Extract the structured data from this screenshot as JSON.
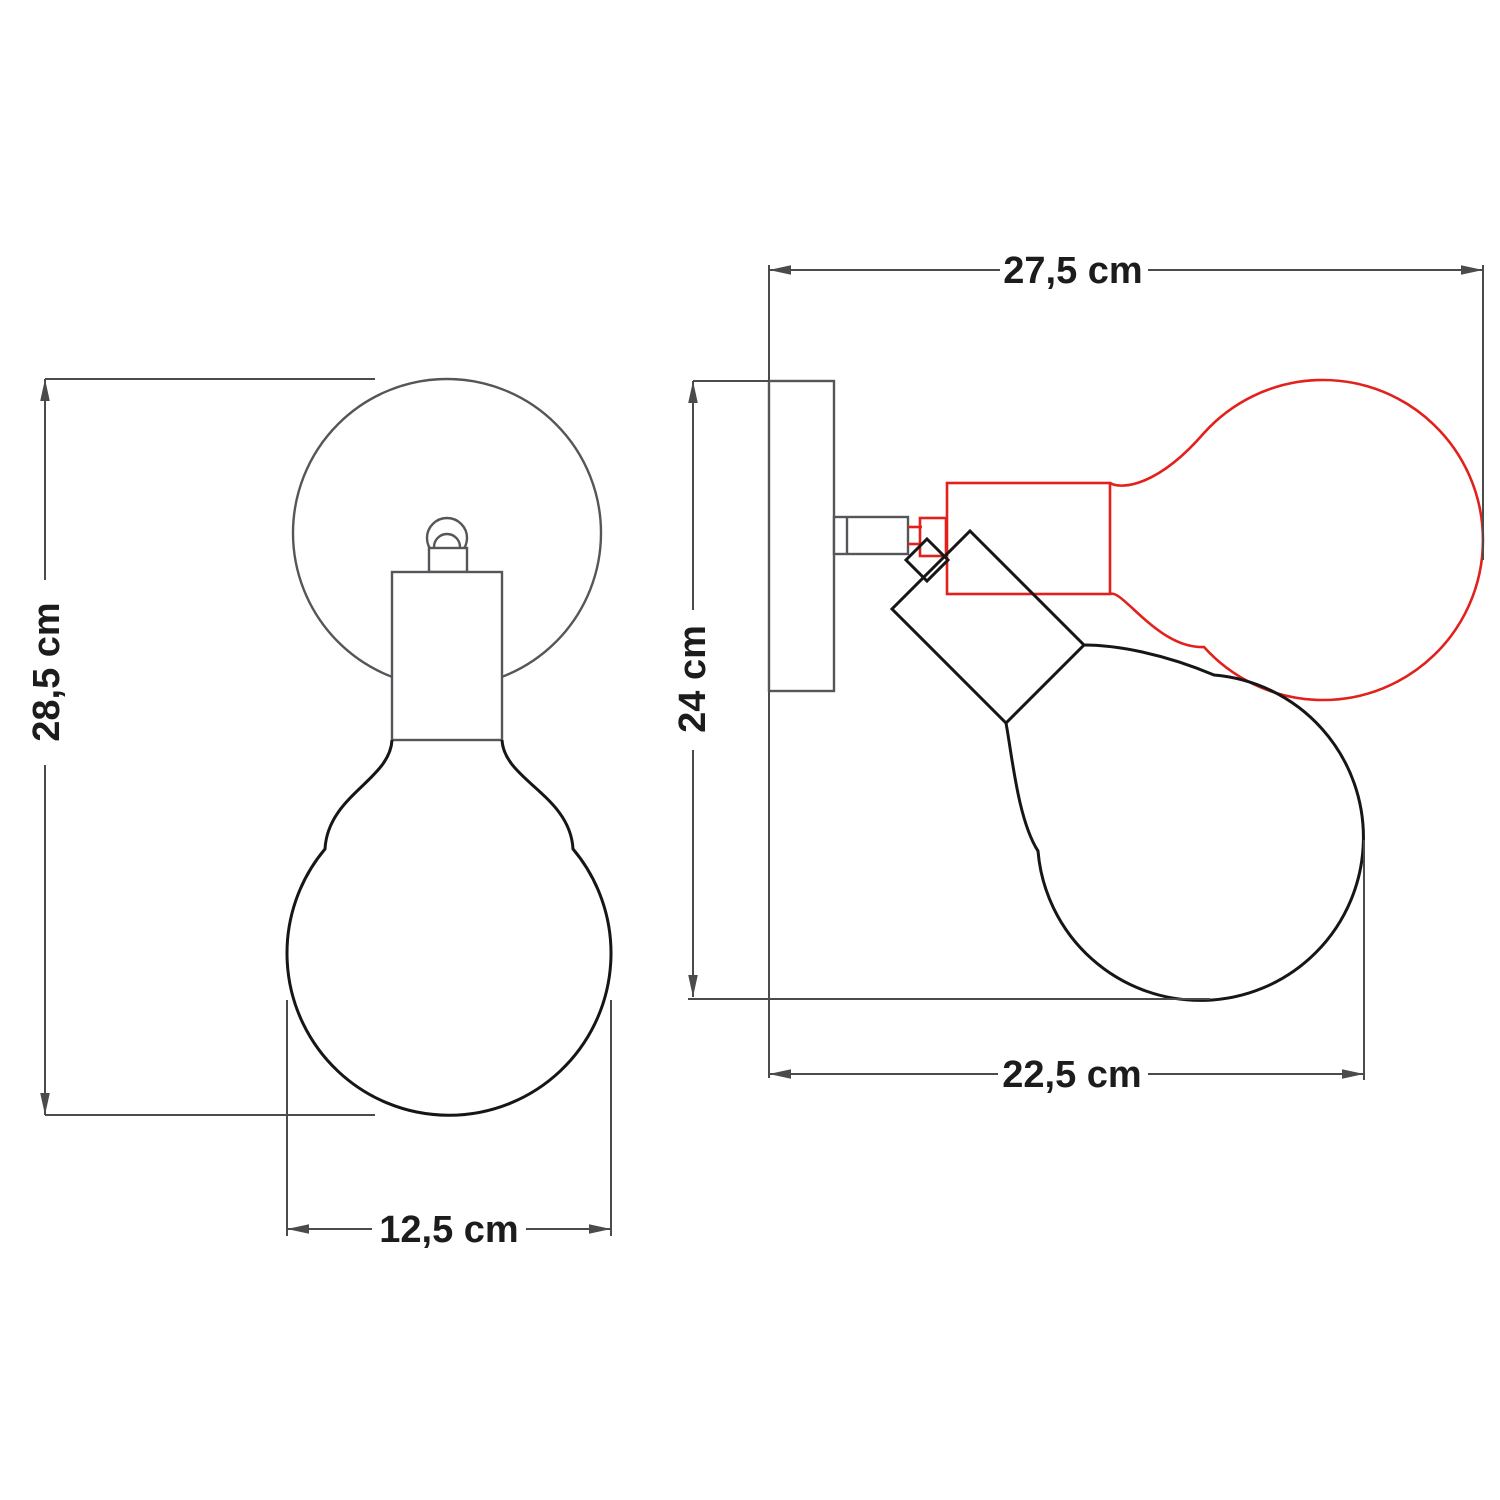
{
  "diagram": {
    "kind": "wall-lamp technical dimension drawing, front and side views",
    "dimensions": {
      "front_height": "28,5 cm",
      "front_bulb_width": "12,5 cm",
      "side_depth": "27,5 cm",
      "side_height": "24 cm",
      "side_width": "22,5 cm"
    },
    "colors": {
      "background": "#ffffff",
      "fixture_outline_gray": "#55565a",
      "bulb_outline_black": "#161616",
      "alternate_position_red": "#e2211c",
      "dimension_line": "#4b4b4d",
      "label_text": "#1c1c1c"
    }
  }
}
